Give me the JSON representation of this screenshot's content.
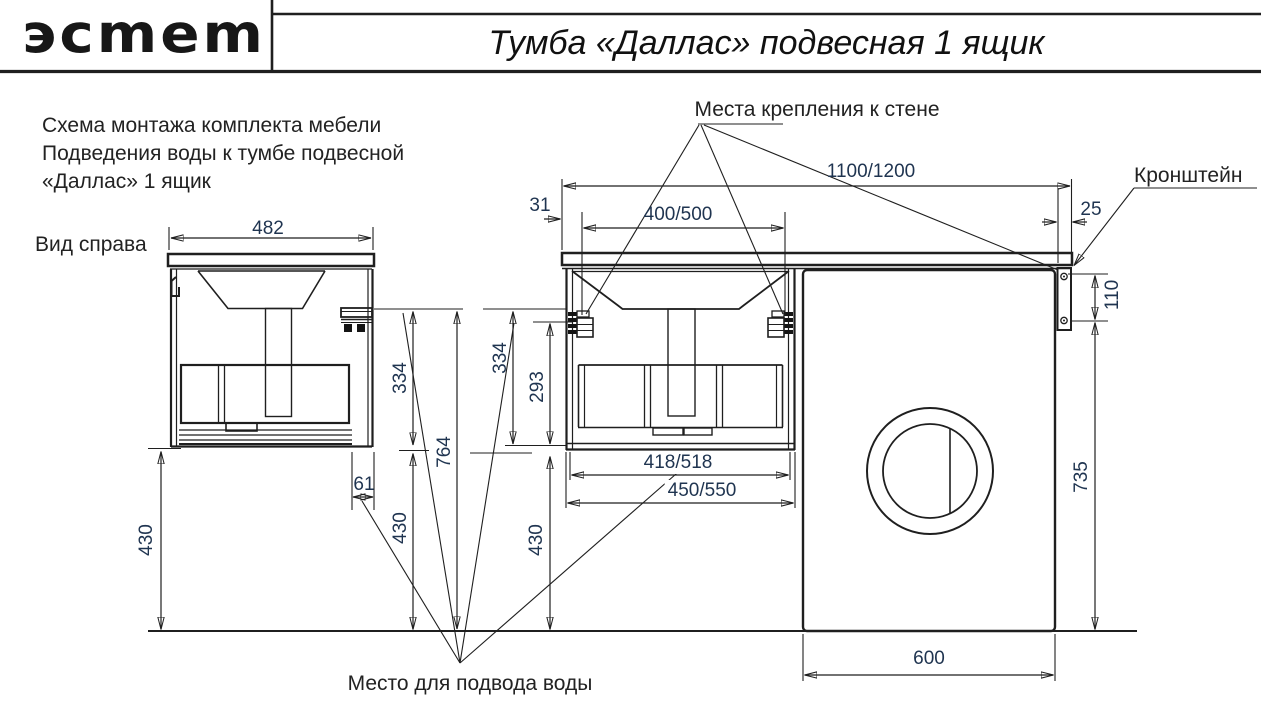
{
  "header": {
    "logo_text": "эсmem",
    "title": "Тумба «Даллас» подвесная 1 ящик"
  },
  "notes": {
    "line1": "Схема монтажа комплекта мебели",
    "line2": "Подведения воды к тумбе подвесной",
    "line3": "«Даллас» 1 ящик"
  },
  "labels": {
    "side_view": "Вид справа",
    "wall_mounts": "Места крепления к стене",
    "bracket": "Кронштейн",
    "water_supply": "Место для подвода воды"
  },
  "dimensions": {
    "side_depth": "482",
    "countertop_length": "1100/1200",
    "edge_to_mount": "31",
    "mount_spacing": "400/500",
    "bracket_inset": "25",
    "bracket_height": "110",
    "cabinet_height_side": "334",
    "cabinet_height_front": "334",
    "drawer_opening_height": "293",
    "water_supply_height": "764",
    "floor_gap_side": "430",
    "floor_gap_mid": "430",
    "floor_gap_front": "430",
    "drain_offset": "61",
    "inner_width": "418/518",
    "cabinet_width": "450/550",
    "washer_height": "735",
    "washer_width": "600"
  },
  "colors": {
    "line": "#1f1f1f",
    "dim_text": "#1f3450",
    "label_text": "#222222"
  }
}
